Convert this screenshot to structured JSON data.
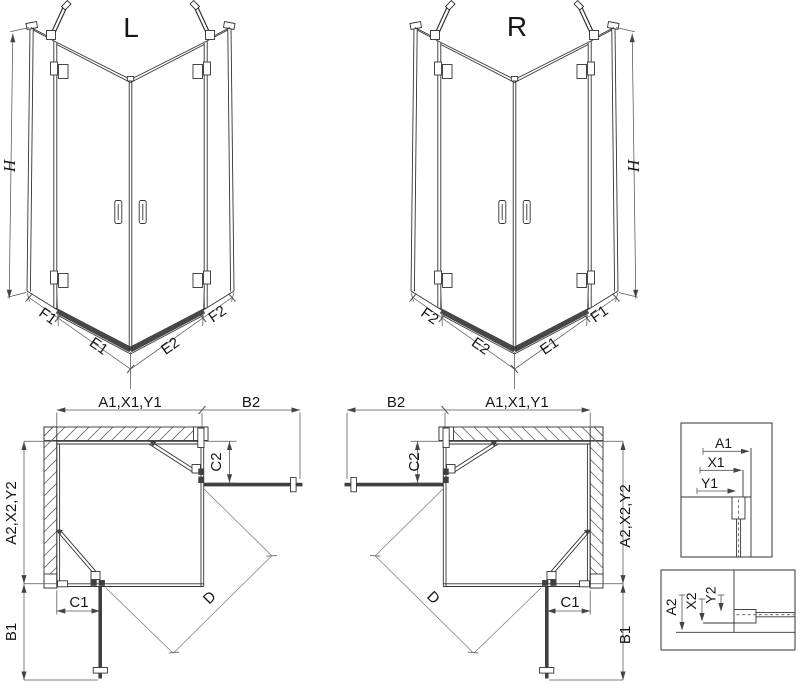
{
  "figures": {
    "iso_left": {
      "label": "L",
      "height": "H",
      "widths": [
        "F1",
        "E1",
        "E2",
        "F2"
      ]
    },
    "iso_right": {
      "label": "R",
      "height": "H",
      "widths": [
        "F2",
        "E2",
        "E1",
        "F1"
      ]
    },
    "plan_left": {
      "width_top": "A1,X1,Y1",
      "door_reach_top": "B2",
      "fixed_top": "C2",
      "depth_side": "A2,X2,Y2",
      "fixed_side": "C1",
      "door_reach_side": "B1",
      "diagonal": "D"
    },
    "plan_right": {
      "width_top": "A1,X1,Y1",
      "door_reach_top": "B2",
      "fixed_top": "C2",
      "depth_side": "A2,X2,Y2",
      "fixed_side": "C1",
      "door_reach_side": "B1",
      "diagonal": "D"
    },
    "detail_top": {
      "dims": [
        "A1",
        "X1",
        "Y1"
      ]
    },
    "detail_bottom": {
      "dims": [
        "A2",
        "X2",
        "Y2"
      ]
    },
    "colors": {
      "line": "#333333",
      "dimension": "#555555",
      "diagonal_dim": "#777777",
      "thick_door": "#3f3f3f",
      "threshold": "#474747",
      "hatch": "#6a6a6a",
      "background": "#ffffff"
    }
  }
}
